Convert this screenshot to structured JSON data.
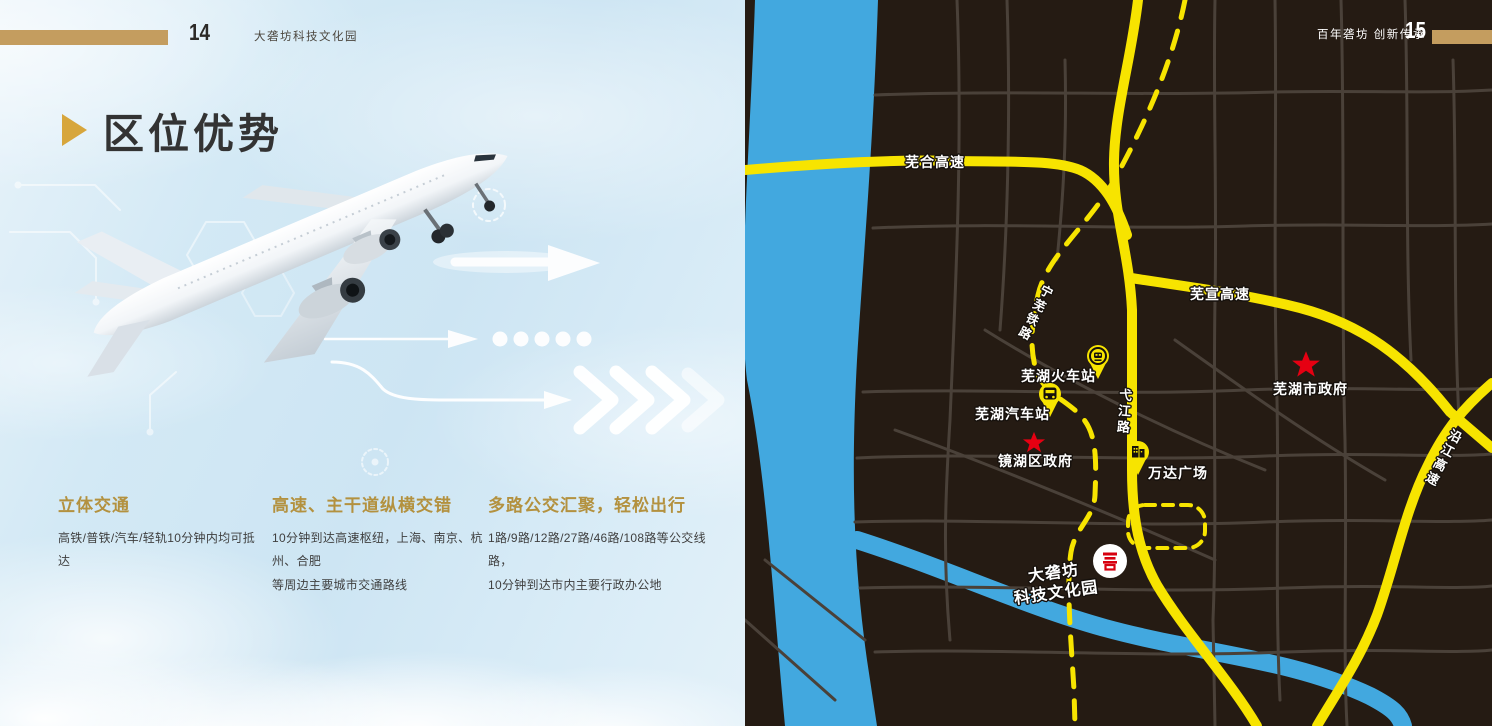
{
  "colors": {
    "gold_bar": "#c49d5f",
    "heading_gold": "#b3913f",
    "title_arrow": "#d7a63c",
    "map_background": "#251b13",
    "road_yellow": "#f7e400",
    "minor_road_gray": "#4a4139",
    "river_blue": "#42a8df",
    "star_red": "#e60012",
    "logo_red": "#d7000f"
  },
  "left_page": {
    "header": {
      "page_number": "14",
      "book_title": "大砻坊科技文化园"
    },
    "section": {
      "title": "区位优势"
    },
    "features": [
      {
        "heading": "立体交通",
        "body": "高铁/普铁/汽车/轻轨10分钟内均可抵达"
      },
      {
        "heading": "高速、主干道纵横交错",
        "body": "10分钟到达高速枢纽，上海、南京、杭州、合肥\n等周边主要城市交通路线"
      },
      {
        "heading": "多路公交汇聚，轻松出行",
        "body": "1路/9路/12路/27路/46路/108路等公交线路，\n10分钟到达市内主要行政办公地"
      }
    ]
  },
  "right_page": {
    "header": {
      "tagline": "百年砻坊 创新传承",
      "page_number": "15"
    },
    "map": {
      "road_labels": {
        "wuhe_expressway": "芜合高速",
        "wuxuan_expressway": "芜宣高速",
        "yijiang_road": "弋江路",
        "yanjiang_expressway": "沿江高速",
        "railway": "宁芜铁路"
      },
      "pois": {
        "train_station": {
          "label": "芜湖火车站",
          "icon": "train"
        },
        "bus_station": {
          "label": "芜湖汽车站",
          "icon": "bus"
        },
        "jinghu_district_gov": {
          "label": "镜湖区政府",
          "icon": "red-star"
        },
        "wanda_plaza": {
          "label": "万达广场",
          "icon": "building"
        },
        "wuhu_city_gov": {
          "label": "芜湖市政府",
          "icon": "red-star"
        },
        "dalongfang_park": {
          "label": "大砻坊\n科技文化园",
          "icon": "park-logo"
        }
      }
    }
  }
}
